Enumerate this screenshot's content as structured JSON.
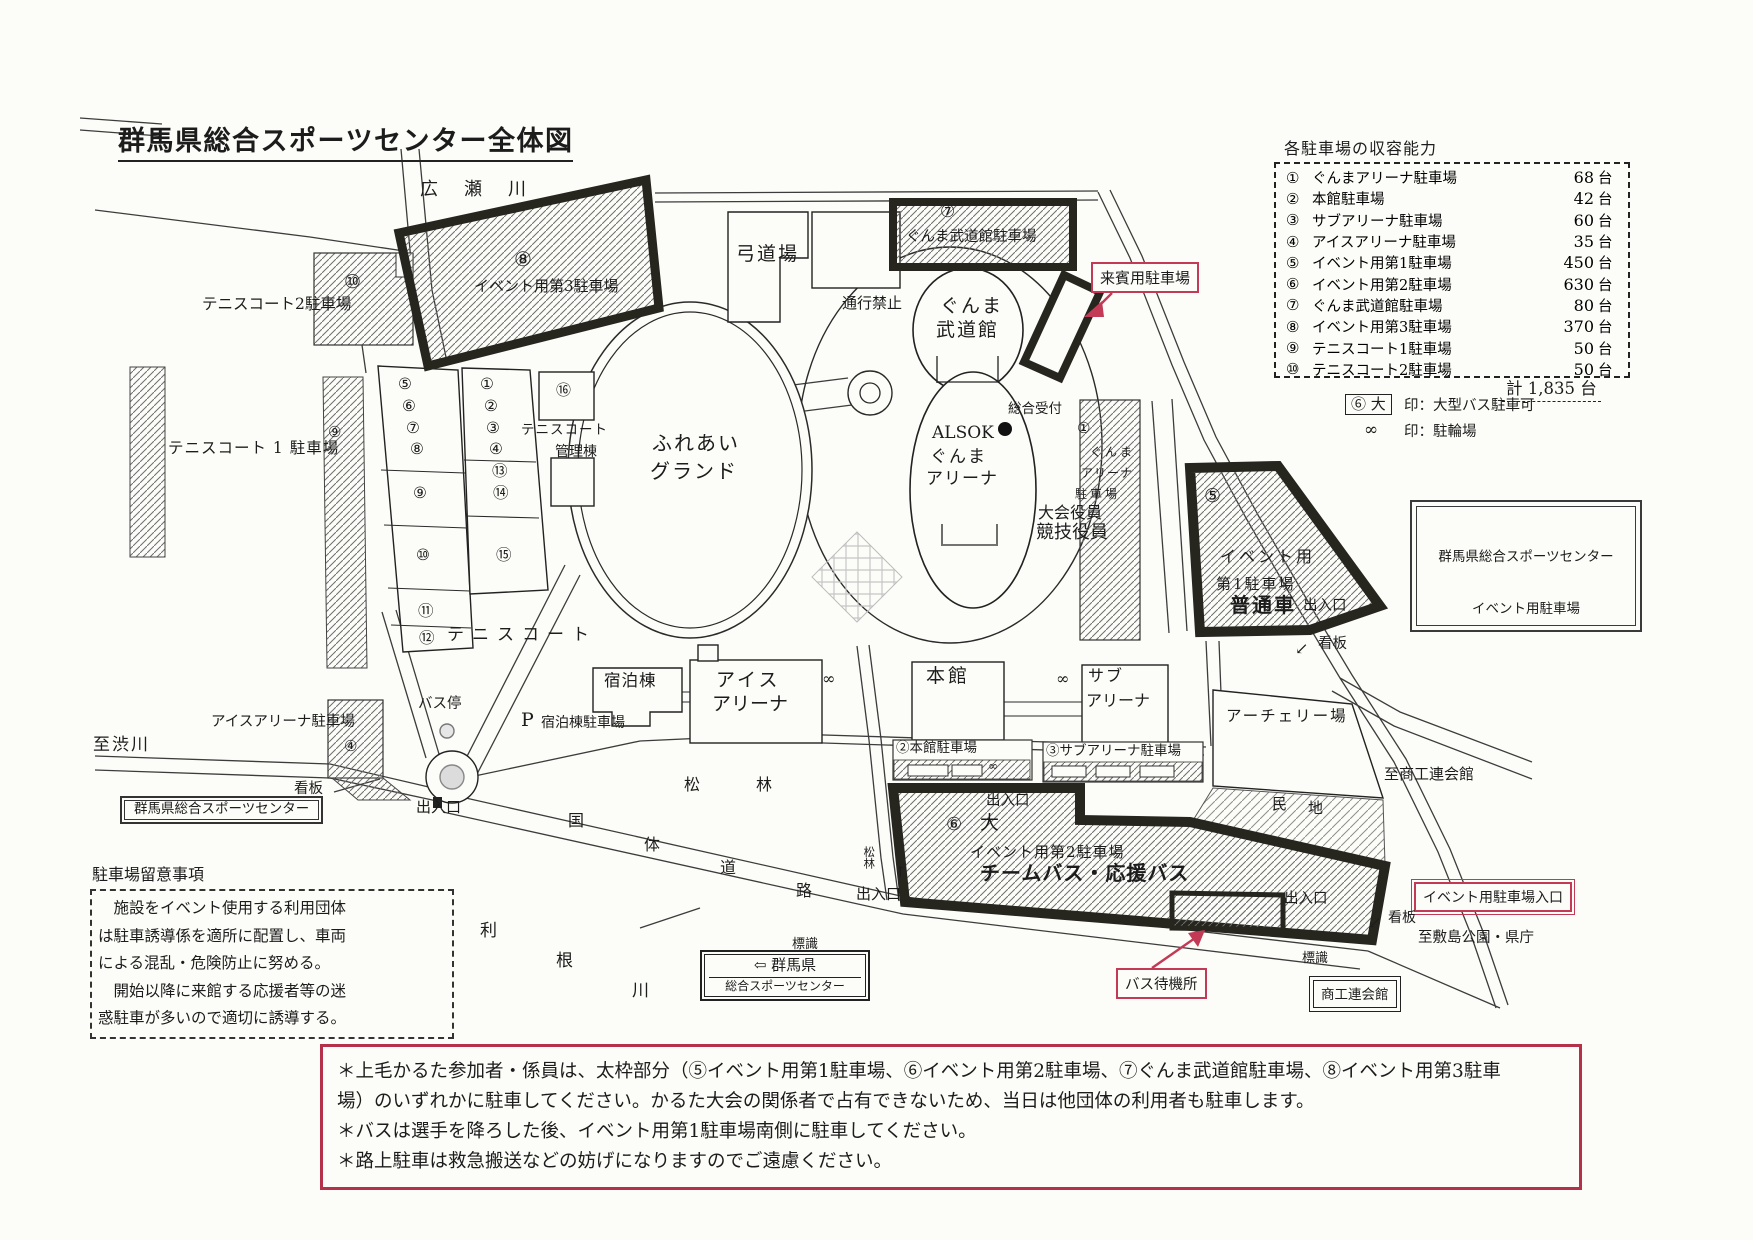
{
  "title": "群馬県総合スポーツセンター全体図",
  "colors": {
    "accent_red": "#c23a55",
    "line_black": "#26261e"
  },
  "legend": {
    "header": "各駐車場の収容能力",
    "unit": "台",
    "total_label": "計 1,835 台",
    "big_symbol": "⑥ 大",
    "big_note": "印：大型バス駐車可",
    "bike_symbol": "∞",
    "bike_note": "印：駐輪場",
    "items": [
      {
        "num": "①",
        "name": "ぐんまアリーナ駐車場",
        "capacity": "68"
      },
      {
        "num": "②",
        "name": "本館駐車場",
        "capacity": "42"
      },
      {
        "num": "③",
        "name": "サブアリーナ駐車場",
        "capacity": "60"
      },
      {
        "num": "④",
        "name": "アイスアリーナ駐車場",
        "capacity": "35"
      },
      {
        "num": "⑤",
        "name": "イベント用第1駐車場",
        "capacity": "450"
      },
      {
        "num": "⑥",
        "name": "イベント用第2駐車場",
        "capacity": "630"
      },
      {
        "num": "⑦",
        "name": "ぐんま武道館駐車場",
        "capacity": "80"
      },
      {
        "num": "⑧",
        "name": "イベント用第3駐車場",
        "capacity": "370"
      },
      {
        "num": "⑨",
        "name": "テニスコート1駐車場",
        "capacity": "50"
      },
      {
        "num": "⑩",
        "name": "テニスコート2駐車場",
        "capacity": "50"
      }
    ]
  },
  "map": {
    "rivers": {
      "hirose": "広　瀬　川",
      "tone1": "利",
      "tone2": "根",
      "tone3": "川"
    },
    "roads": {
      "k1": "国",
      "k2": "体",
      "k3": "道",
      "k4": "路",
      "to_shibukawa": "至渋川",
      "to_shokoren": "至商工連会館",
      "to_shikishima": "至敷島公園・県庁",
      "no_entry": "通行禁止",
      "pine1": "松",
      "pine2": "林",
      "pine_small": "松林"
    },
    "facilities": {
      "kyudojo": "弓道場",
      "budokan1": "ぐんま",
      "budokan2": "武道館",
      "arena1": "ALSOK",
      "arena2": "ぐんま",
      "arena3": "アリーナ",
      "ground1": "ふれあい",
      "ground2": "グランド",
      "reception": "総合受付",
      "officials1": "大会役員",
      "officials2": "競技役員",
      "honkan": "本館",
      "sub1": "サブ",
      "sub2": "アリーナ",
      "ice1": "アイス",
      "ice2": "アリーナ",
      "lodge": "宿泊棟",
      "lodge_p": "P",
      "lodge_parking": "宿泊棟駐車場",
      "archery": "アーチェリー場",
      "kanri1": "テニスコート",
      "kanri2": "管理棟",
      "tennis": "テニスコート",
      "minchi1": "民",
      "minchi2": "地",
      "bus_stop": "バス停"
    },
    "parkings": {
      "p1_num": "①",
      "p1_l1": "ぐんま",
      "p1_l2": "アリーナ",
      "p1_l3": "駐車場",
      "p2": "②本館駐車場",
      "p3": "③サブアリーナ駐車場",
      "p4_name": "アイスアリーナ駐車場",
      "p4_num": "④",
      "p5_num": "⑤",
      "p5_l1": "イベント用",
      "p5_l2": "第1駐車場",
      "p5_l3": "普通車",
      "p6_num": "⑥",
      "p6_big": "大",
      "p6_l1": "イベント用第2駐車場",
      "p6_l2": "チームバス・応援バス",
      "p7_num": "⑦",
      "p7_name": "ぐんま武道館駐車場",
      "p8_num": "⑧",
      "p8_name": "イベント用第3駐車場",
      "p9_num": "⑨",
      "p9_name": "テニスコート 1 駐車場",
      "p10_num": "⑩",
      "p10_name": "テニスコート2駐車場",
      "guest": "来賓用駐車場"
    },
    "courts": {
      "left": [
        "⑤",
        "⑥",
        "⑦",
        "⑧",
        "⑨",
        "⑩",
        "⑪",
        "⑫"
      ],
      "right": [
        "①",
        "②",
        "③",
        "④",
        "⑬",
        "⑭",
        "⑮"
      ],
      "c16": "⑯"
    },
    "markers": {
      "deiriguchi": "出入口",
      "kanban": "看板",
      "hyoshiki": "標識",
      "inf": "∞",
      "up_arrow": "↑",
      "dl_arrow": "↙"
    },
    "signs": {
      "left_sign": "群馬県総合スポーツセンター",
      "bottom_sign1": "⇦ 群馬県",
      "bottom_sign2": "総合スポーツセンター",
      "right_sign1": "群馬県総合スポーツセンター",
      "right_sign2": "イベント用駐車場",
      "shokoren": "商工連会館",
      "bus_wait": "バス待機所",
      "event_entrance": "イベント用駐車場入口"
    },
    "notes": {
      "caution_title": "駐車場留意事項",
      "caution_l1": "　施設をイベント使用する利用団体",
      "caution_l2": "は駐車誘導係を適所に配置し、車両",
      "caution_l3": "による混乱・危険防止に努める。",
      "caution_l4": "　開始以降に来館する応援者等の迷",
      "caution_l5": "惑駐車が多いので適切に誘導する。",
      "bottom_l1": "＊上毛かるた参加者・係員は、太枠部分（⑤イベント用第1駐車場、⑥イベント用第2駐車場、⑦ぐんま武道館駐車場、⑧イベント用第3駐車",
      "bottom_l2": "場）のいずれかに駐車してください。かるた大会の関係者で占有できないため、当日は他団体の利用者も駐車します。",
      "bottom_l3": "＊バスは選手を降ろした後、イベント用第1駐車場南側に駐車してください。",
      "bottom_l4": "＊路上駐車は救急搬送などの妨げになりますのでご遠慮ください。"
    }
  }
}
